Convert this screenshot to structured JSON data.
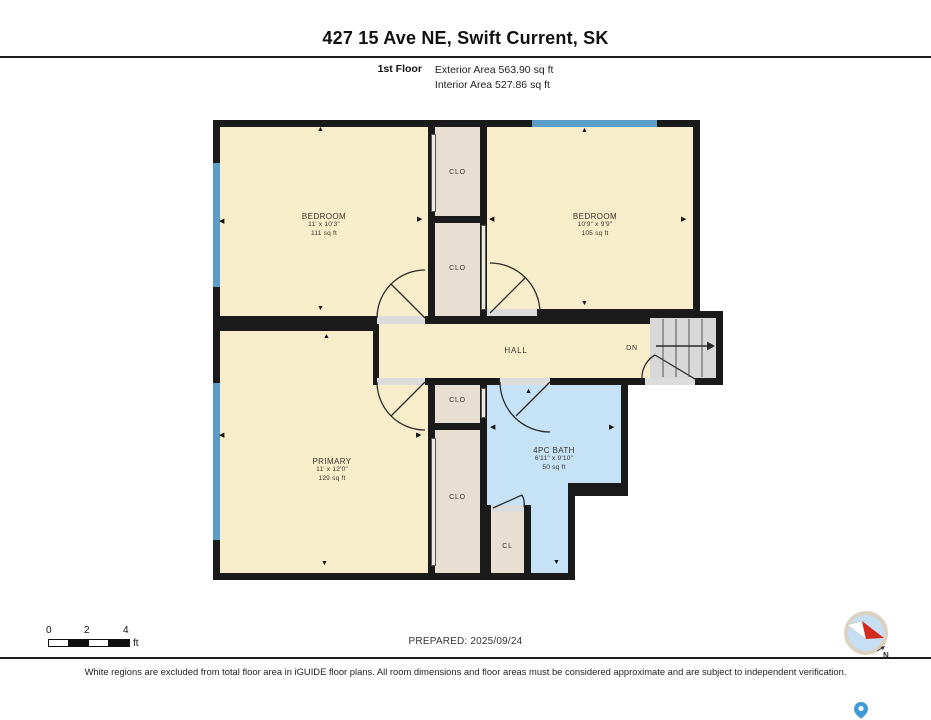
{
  "header": {
    "title": "427 15 Ave NE, Swift Current, SK",
    "floor_label": "1st Floor",
    "exterior_area": "Exterior Area 563.90 sq ft",
    "interior_area": "Interior Area 527.86 sq ft"
  },
  "rooms": {
    "bedroom1": {
      "name": "BEDROOM",
      "dims": "11' x 10'3\"",
      "area": "111 sq ft"
    },
    "bedroom2": {
      "name": "BEDROOM",
      "dims": "10'9\" x 9'9\"",
      "area": "105 sq ft"
    },
    "primary": {
      "name": "PRIMARY",
      "dims": "11' x 12'0\"",
      "area": "129 sq ft"
    },
    "bath": {
      "name": "4PC BATH",
      "dims": "6'11\" x 9'10\"",
      "area": "50 sq ft"
    },
    "hall": {
      "name": "HALL"
    },
    "closet_label": "CLO",
    "small_closet_label": "CL",
    "stairs_label": "DN"
  },
  "glyphs": {
    "up": "▲",
    "down": "▼",
    "left": "◀",
    "right": "▶"
  },
  "scale": {
    "t0": "0",
    "t2": "2",
    "t4": "4",
    "unit": "ft"
  },
  "footer": {
    "prepared": "PREPARED: 2025/09/24",
    "disclaimer": "White regions are excluded from total floor area in iGUIDE floor plans. All room dimensions and floor areas must be considered approximate and are subject to independent verification."
  },
  "compass": {
    "north": "N"
  },
  "colors": {
    "wall": "#1a1a1a",
    "room_fill": "#f8edca",
    "closet_fill": "#e7dfd2",
    "bath_fill": "#c5e2f6",
    "window": "#5b9dc9",
    "stairs": "#d8d8d8"
  }
}
